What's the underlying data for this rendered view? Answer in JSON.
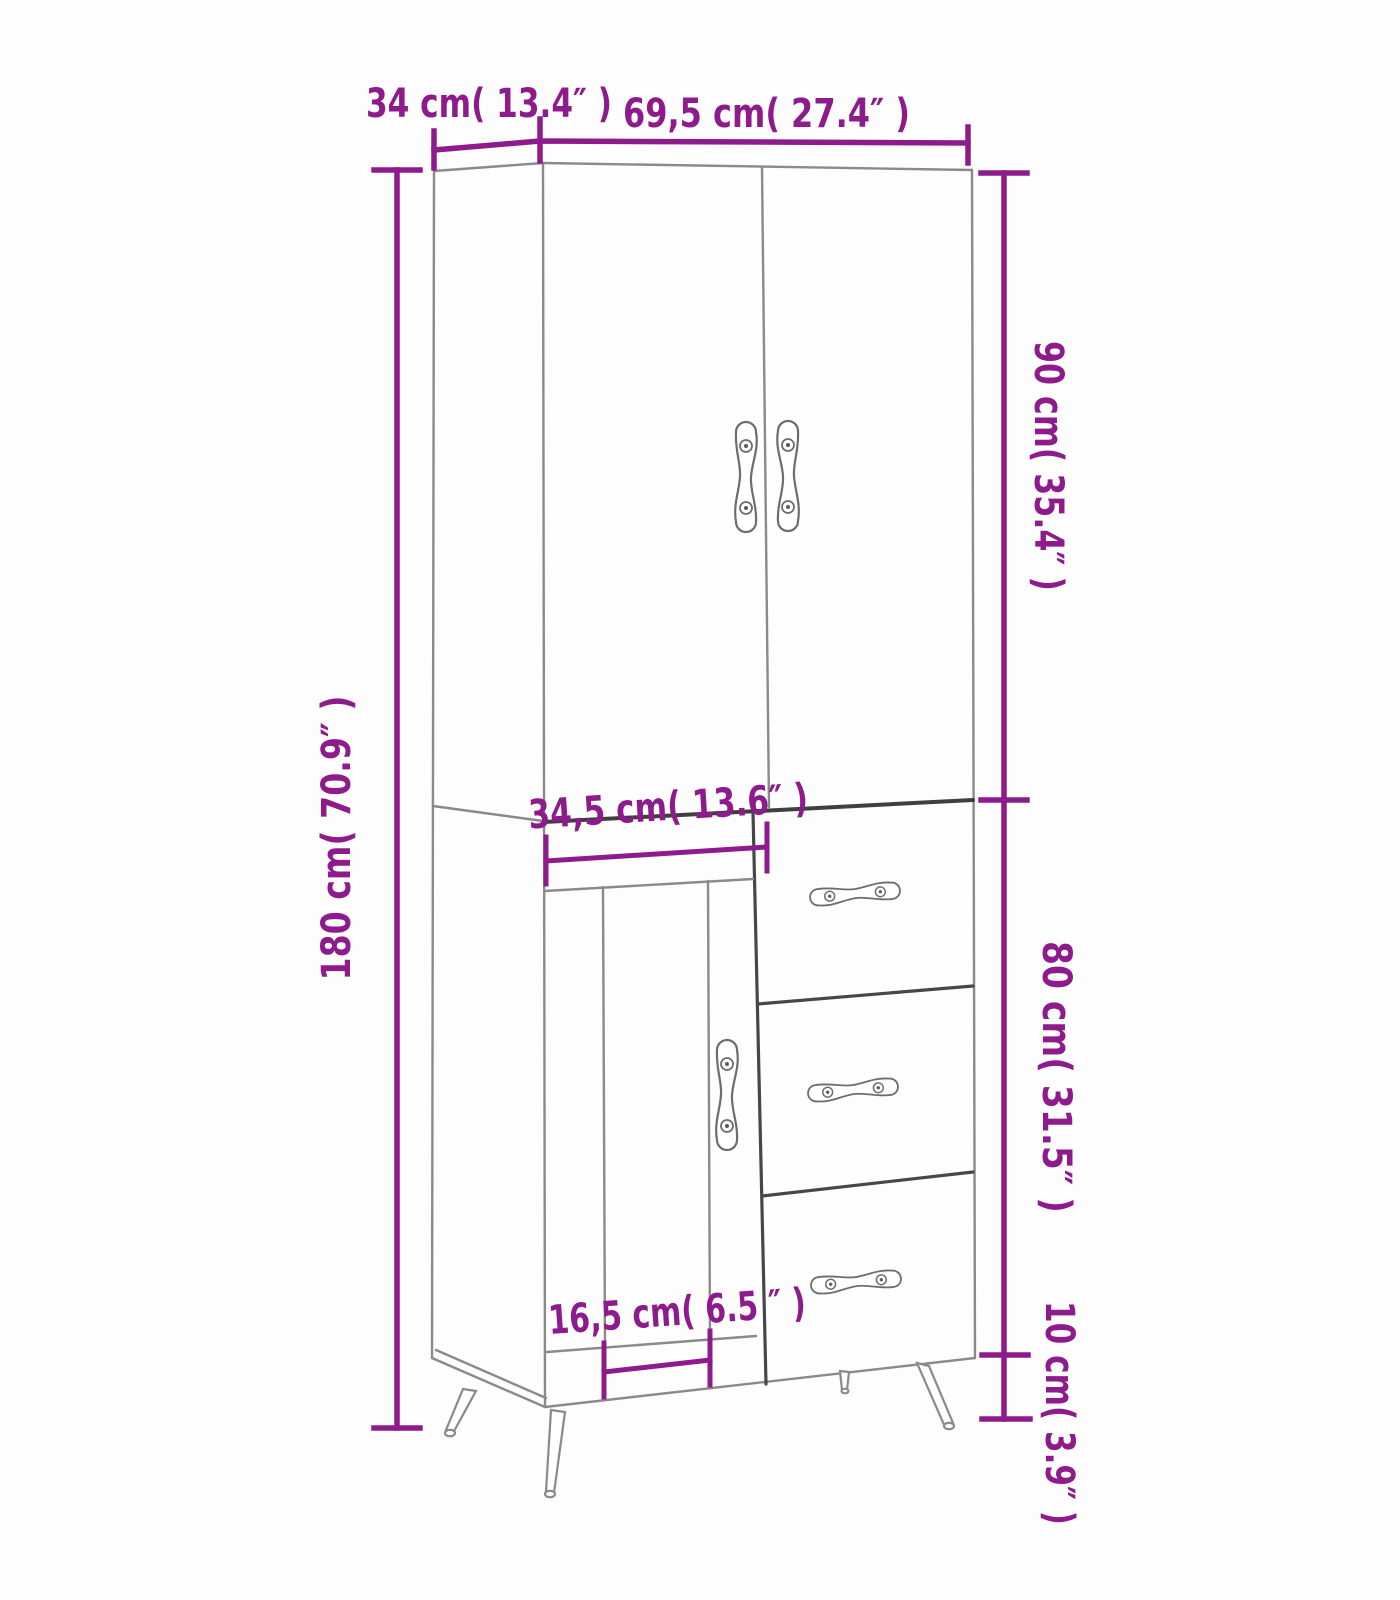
{
  "diagram": {
    "type": "furniture-dimension-diagram",
    "subject": "tall highboard cabinet with two upper doors, one lower door and three drawers on metal legs",
    "colors": {
      "dimension_accent": "#8E1B8C",
      "outline_light": "#8a8a8a",
      "outline_dark": "#3f3f3f",
      "background": "#fdfdfd"
    },
    "labels": {
      "top_depth": "34 cm( 13.4″ )",
      "top_width": "69,5 cm( 27.4″ )",
      "right_upper_height": "90 cm( 35.4″ )",
      "left_total_height": "180 cm( 70.9″ )",
      "middle_door_width": "34,5 cm( 13.6″ )",
      "right_lower_height": "80 cm( 31.5″ )",
      "bottom_panel_width": "16,5 cm( 6.5 ″ )",
      "right_leg_height": "10 cm( 3.9″ )"
    },
    "measurements": [
      {
        "part": "depth",
        "cm": 34,
        "inch": 13.4
      },
      {
        "part": "overall-width",
        "cm": 69.5,
        "inch": 27.4
      },
      {
        "part": "upper-section-height",
        "cm": 90,
        "inch": 35.4
      },
      {
        "part": "total-height",
        "cm": 180,
        "inch": 70.9
      },
      {
        "part": "lower-door-width",
        "cm": 34.5,
        "inch": 13.6
      },
      {
        "part": "lower-section-height",
        "cm": 80,
        "inch": 31.5
      },
      {
        "part": "door-panel-width",
        "cm": 16.5,
        "inch": 6.5
      },
      {
        "part": "leg-height",
        "cm": 10,
        "inch": 3.9
      }
    ]
  }
}
